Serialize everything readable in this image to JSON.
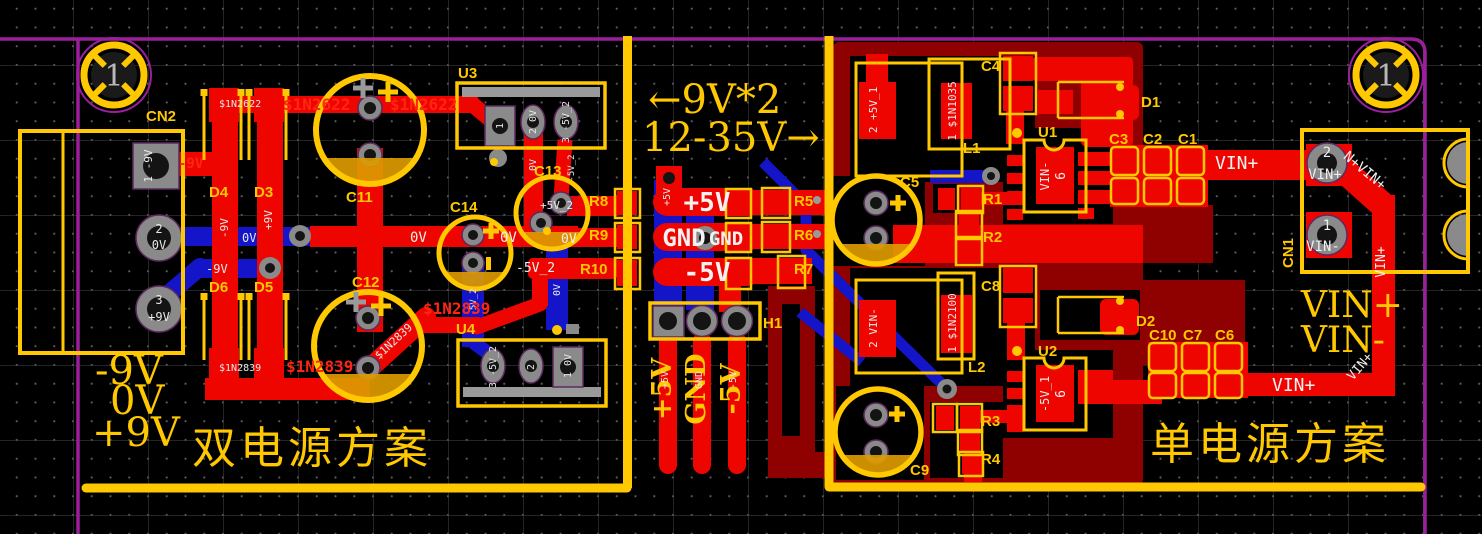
{
  "titles": {
    "dual": "双电源方案",
    "single": "单电源方案"
  },
  "notes": {
    "top": "←9V*2",
    "bottom": "12-35V→"
  },
  "rails": {
    "l1": "-9V",
    "l2": "0V",
    "l3": "+9V",
    "r1": "VIN+",
    "r2": "VIN-"
  },
  "fiducial": {
    "label": "1"
  },
  "refs": {
    "CN1": "CN1",
    "CN2": "CN2",
    "H1": "H1",
    "U1": "U1",
    "U2": "U2",
    "U3": "U3",
    "U4": "U4",
    "L1": "L1",
    "L2": "L2",
    "D1": "D1",
    "D2": "D2",
    "D3": "D3",
    "D4": "D4",
    "D5": "D5",
    "D6": "D6",
    "R1": "R1",
    "R2": "R2",
    "R3": "R3",
    "R4": "R4",
    "R5": "R5",
    "R6": "R6",
    "R7": "R7",
    "R8": "R8",
    "R9": "R9",
    "R10": "R10",
    "C1": "C1",
    "C2": "C2",
    "C3": "C3",
    "C4": "C4",
    "C5": "C5",
    "C6": "C6",
    "C7": "C7",
    "C8": "C8",
    "C9": "C9",
    "C10": "C10",
    "C11": "C11",
    "C12": "C12",
    "C13": "C13",
    "C14": "C14"
  },
  "nets": {
    "m9v": "-9V",
    "zv": "0V",
    "p9v": "+9V",
    "p5v": "+5V",
    "m5v": "-5V",
    "gnd": "GND",
    "p5v1": "+5V_1",
    "p5v2": "+5V_2",
    "m5v1": "-5V_1",
    "m5v2": "-5V_2",
    "vinp": "VIN+",
    "vinm": "VIN-",
    "vchain": "N+VIN+",
    "d2622": "$1N2622",
    "d2839": "$1N2839",
    "d1035": "$1N1035",
    "d2100": "$1N2100"
  },
  "pins": {
    "n1": "1",
    "n2": "2",
    "n3": "3",
    "n6": "6"
  },
  "pads": {
    "cn2_1": "1 -9V",
    "u3_2": "2 0V",
    "u3_3": "3 -5V_2",
    "u4_1": "1 0V",
    "u4_3": "3 -5V_2",
    "l1_2": "2 +5V_1",
    "l1_1": "1 $1N1035",
    "l2_2": "2 VIN-",
    "l2_1": "1 $1N2100"
  },
  "colors": {
    "background": "#000000",
    "board_outline": "#9b1f9b",
    "silkscreen": "#ffc800",
    "copper_top": "#ee0500",
    "copper_bottom": "#1414c8",
    "copper_pour": "#8f0000",
    "pad_gray": "#8a8a8a",
    "electrolyte_mark": "#dc9a00"
  }
}
